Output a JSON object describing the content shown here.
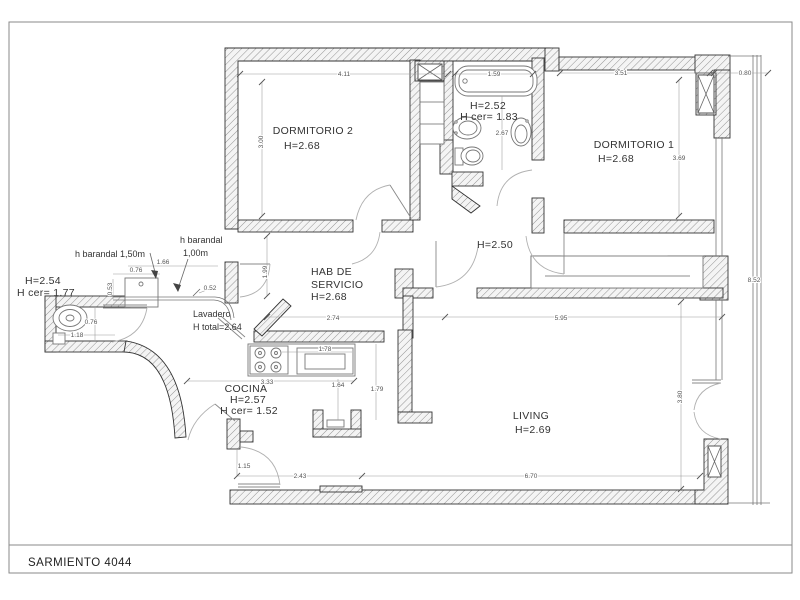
{
  "sheet": {
    "title": "SARMIENTO 4044"
  },
  "rooms": {
    "dormitorio2": {
      "name": "DORMITORIO 2",
      "h": "H=2.68"
    },
    "dormitorio1": {
      "name": "DORMITORIO 1",
      "h": "H=2.68"
    },
    "banio": {
      "h": "H=2.52",
      "hcer": "H cer= 1.83"
    },
    "hab_servicio": {
      "line1": "HAB DE",
      "line2": "SERVICIO",
      "h": "H=2.68"
    },
    "hall": {
      "h": "H=2.50"
    },
    "toilette": {
      "h": "H=2.54",
      "hcer": "H cer= 1.77"
    },
    "lavadero": {
      "name": "Lavadero",
      "h": "H total=2.64"
    },
    "cocina": {
      "name": "COCINA",
      "h": "H=2.57",
      "hcer": "H cer= 1.52"
    },
    "living": {
      "name": "LIVING",
      "h": "H=2.69"
    }
  },
  "annotations": {
    "barandal_150": "h barandal 1,50m",
    "barandal_100a": "h barandal",
    "barandal_100b": "1,00m"
  },
  "dims": {
    "top_dorm2": "4.11",
    "top_tub": "1.59",
    "top_dorm1": "3.51",
    "top_balcony": "0.80",
    "dorm2_w": "3.00",
    "banio_h": "2.67",
    "dorm1_h": "3.69",
    "balcony_h": "8.52",
    "habserv_h": "1.99",
    "habserv_w": "2.74",
    "hall_living_w": "5.95",
    "balc_166": "1.66",
    "balc_076": "0.76",
    "balc_053": "0.53",
    "balc_052": "0.52",
    "toil_076": "0.76",
    "toil_118": "1.18",
    "cocina_w": "3.33",
    "counter_w": "1.78",
    "cocina_164": "1.64",
    "cocina_179": "1.79",
    "living_h": "3.80",
    "living_w": "6.70",
    "entry_w": "2.43",
    "entry_door": "1.15"
  }
}
